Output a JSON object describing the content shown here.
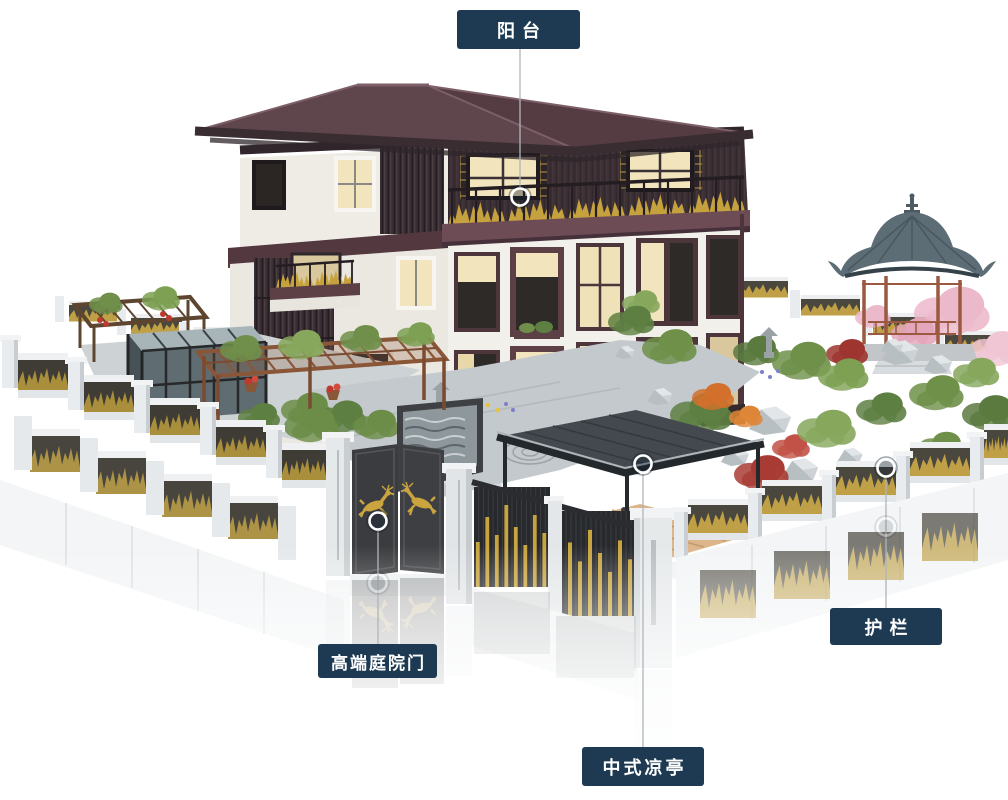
{
  "page": {
    "type": "annotated-architectural-render",
    "background": "#ffffff"
  },
  "callouts": [
    {
      "id": "balcony",
      "label": "阳台",
      "target": "balcony-railing"
    },
    {
      "id": "courtyard-gate",
      "label": "高端庭院门",
      "target": "courtyard-gate-doors"
    },
    {
      "id": "pavilion",
      "label": "中式凉亭",
      "target": "pavilion-roof"
    },
    {
      "id": "railing",
      "label": "护栏",
      "target": "perimeter-fence"
    }
  ],
  "style": {
    "badge_bg": "#1d3a52",
    "badge_text": "#ffffff",
    "callout_line": "#aeb6bd",
    "marker_ring": "#ffffff",
    "marker_fill": "rgba(18,32,48,0.38)",
    "gold_accent": "#c6a23e",
    "roof_color": "#5f454c",
    "gazebo_roof": "#5d6d75",
    "wood_color": "#9a5940"
  }
}
